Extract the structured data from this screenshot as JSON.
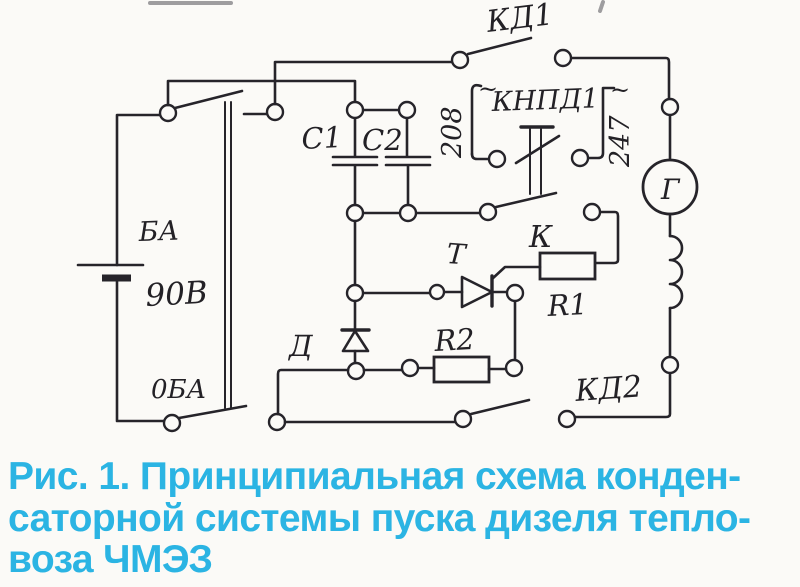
{
  "diagram": {
    "ink_color": "#26242a",
    "paper_color": "#fbfaf7",
    "labels": {
      "kd1": "КД1",
      "tilde_left": "~",
      "tilde_right": "~",
      "wire_left": "208",
      "knpd1": "КНПД1",
      "wire_right": "247",
      "battery_name": "БА",
      "battery_voltage": "90В",
      "battery_zero": "0БА",
      "c1": "C1",
      "c2": "C2",
      "generator": "Г",
      "thyristor": "Т",
      "relay_k": "К",
      "r1": "R1",
      "r2": "R2",
      "diode": "Д",
      "kd2": "КД2"
    }
  },
  "caption": {
    "color": "#2bb4e3",
    "lines": [
      "Рис. 1. Принципиальная схема конден-",
      "саторной системы пуска дизеля тепло-",
      "воза ЧМЭЗ"
    ]
  }
}
